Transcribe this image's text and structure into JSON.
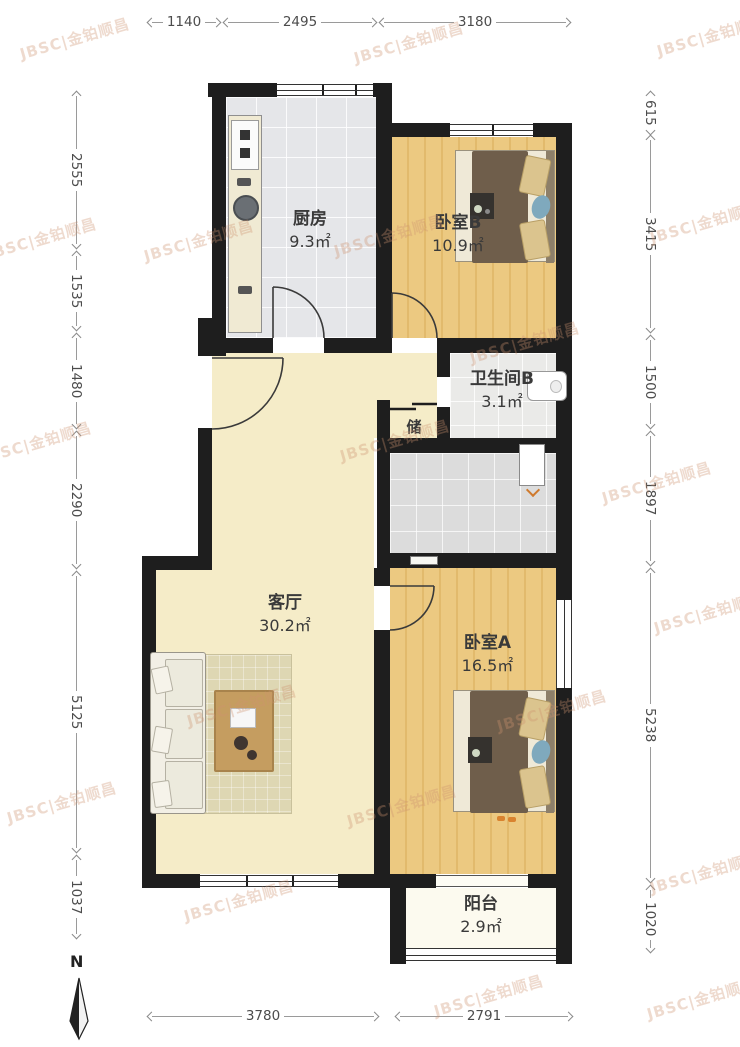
{
  "meta": {
    "north_label": "N"
  },
  "watermark": {
    "text": "JBSC|金铂顺昌",
    "positions": [
      [
        18,
        28
      ],
      [
        352,
        32
      ],
      [
        655,
        25
      ],
      [
        -15,
        228
      ],
      [
        142,
        230
      ],
      [
        332,
        225
      ],
      [
        648,
        212
      ],
      [
        468,
        332
      ],
      [
        -20,
        432
      ],
      [
        338,
        430
      ],
      [
        600,
        472
      ],
      [
        185,
        695
      ],
      [
        495,
        700
      ],
      [
        345,
        795
      ],
      [
        652,
        602
      ],
      [
        5,
        792
      ],
      [
        648,
        862
      ],
      [
        182,
        890
      ],
      [
        432,
        985
      ],
      [
        645,
        988
      ]
    ]
  },
  "rooms": [
    {
      "id": "kitchen",
      "name": "厨房",
      "area": "9.3㎡"
    },
    {
      "id": "bedroom-b",
      "name": "卧室B",
      "area": "10.9㎡"
    },
    {
      "id": "bathroom-b",
      "name": "卫生间B",
      "area": "3.1㎡"
    },
    {
      "id": "storage",
      "name": "储",
      "area": ""
    },
    {
      "id": "living",
      "name": "客厅",
      "area": "30.2㎡"
    },
    {
      "id": "bedroom-a",
      "name": "卧室A",
      "area": "16.5㎡"
    },
    {
      "id": "balcony",
      "name": "阳台",
      "area": "2.9㎡"
    }
  ],
  "dimensions": {
    "top": [
      {
        "value": "1140"
      },
      {
        "value": "2495"
      },
      {
        "value": "3180"
      }
    ],
    "bottom": [
      {
        "value": "3780"
      },
      {
        "value": "2791"
      }
    ],
    "left": [
      {
        "value": "2555"
      },
      {
        "value": "1535"
      },
      {
        "value": "1480"
      },
      {
        "value": "2290"
      },
      {
        "value": "5125"
      },
      {
        "value": "1037"
      }
    ],
    "right": [
      {
        "value": "615"
      },
      {
        "value": "3415"
      },
      {
        "value": "1500"
      },
      {
        "value": "1897"
      },
      {
        "value": "5238"
      },
      {
        "value": "1020"
      }
    ]
  },
  "colors": {
    "wall": "#1e1e1e",
    "wood": "#ecc981",
    "cream": "#f5ecc8",
    "watermark": "rgba(205,148,112,0.34)"
  }
}
